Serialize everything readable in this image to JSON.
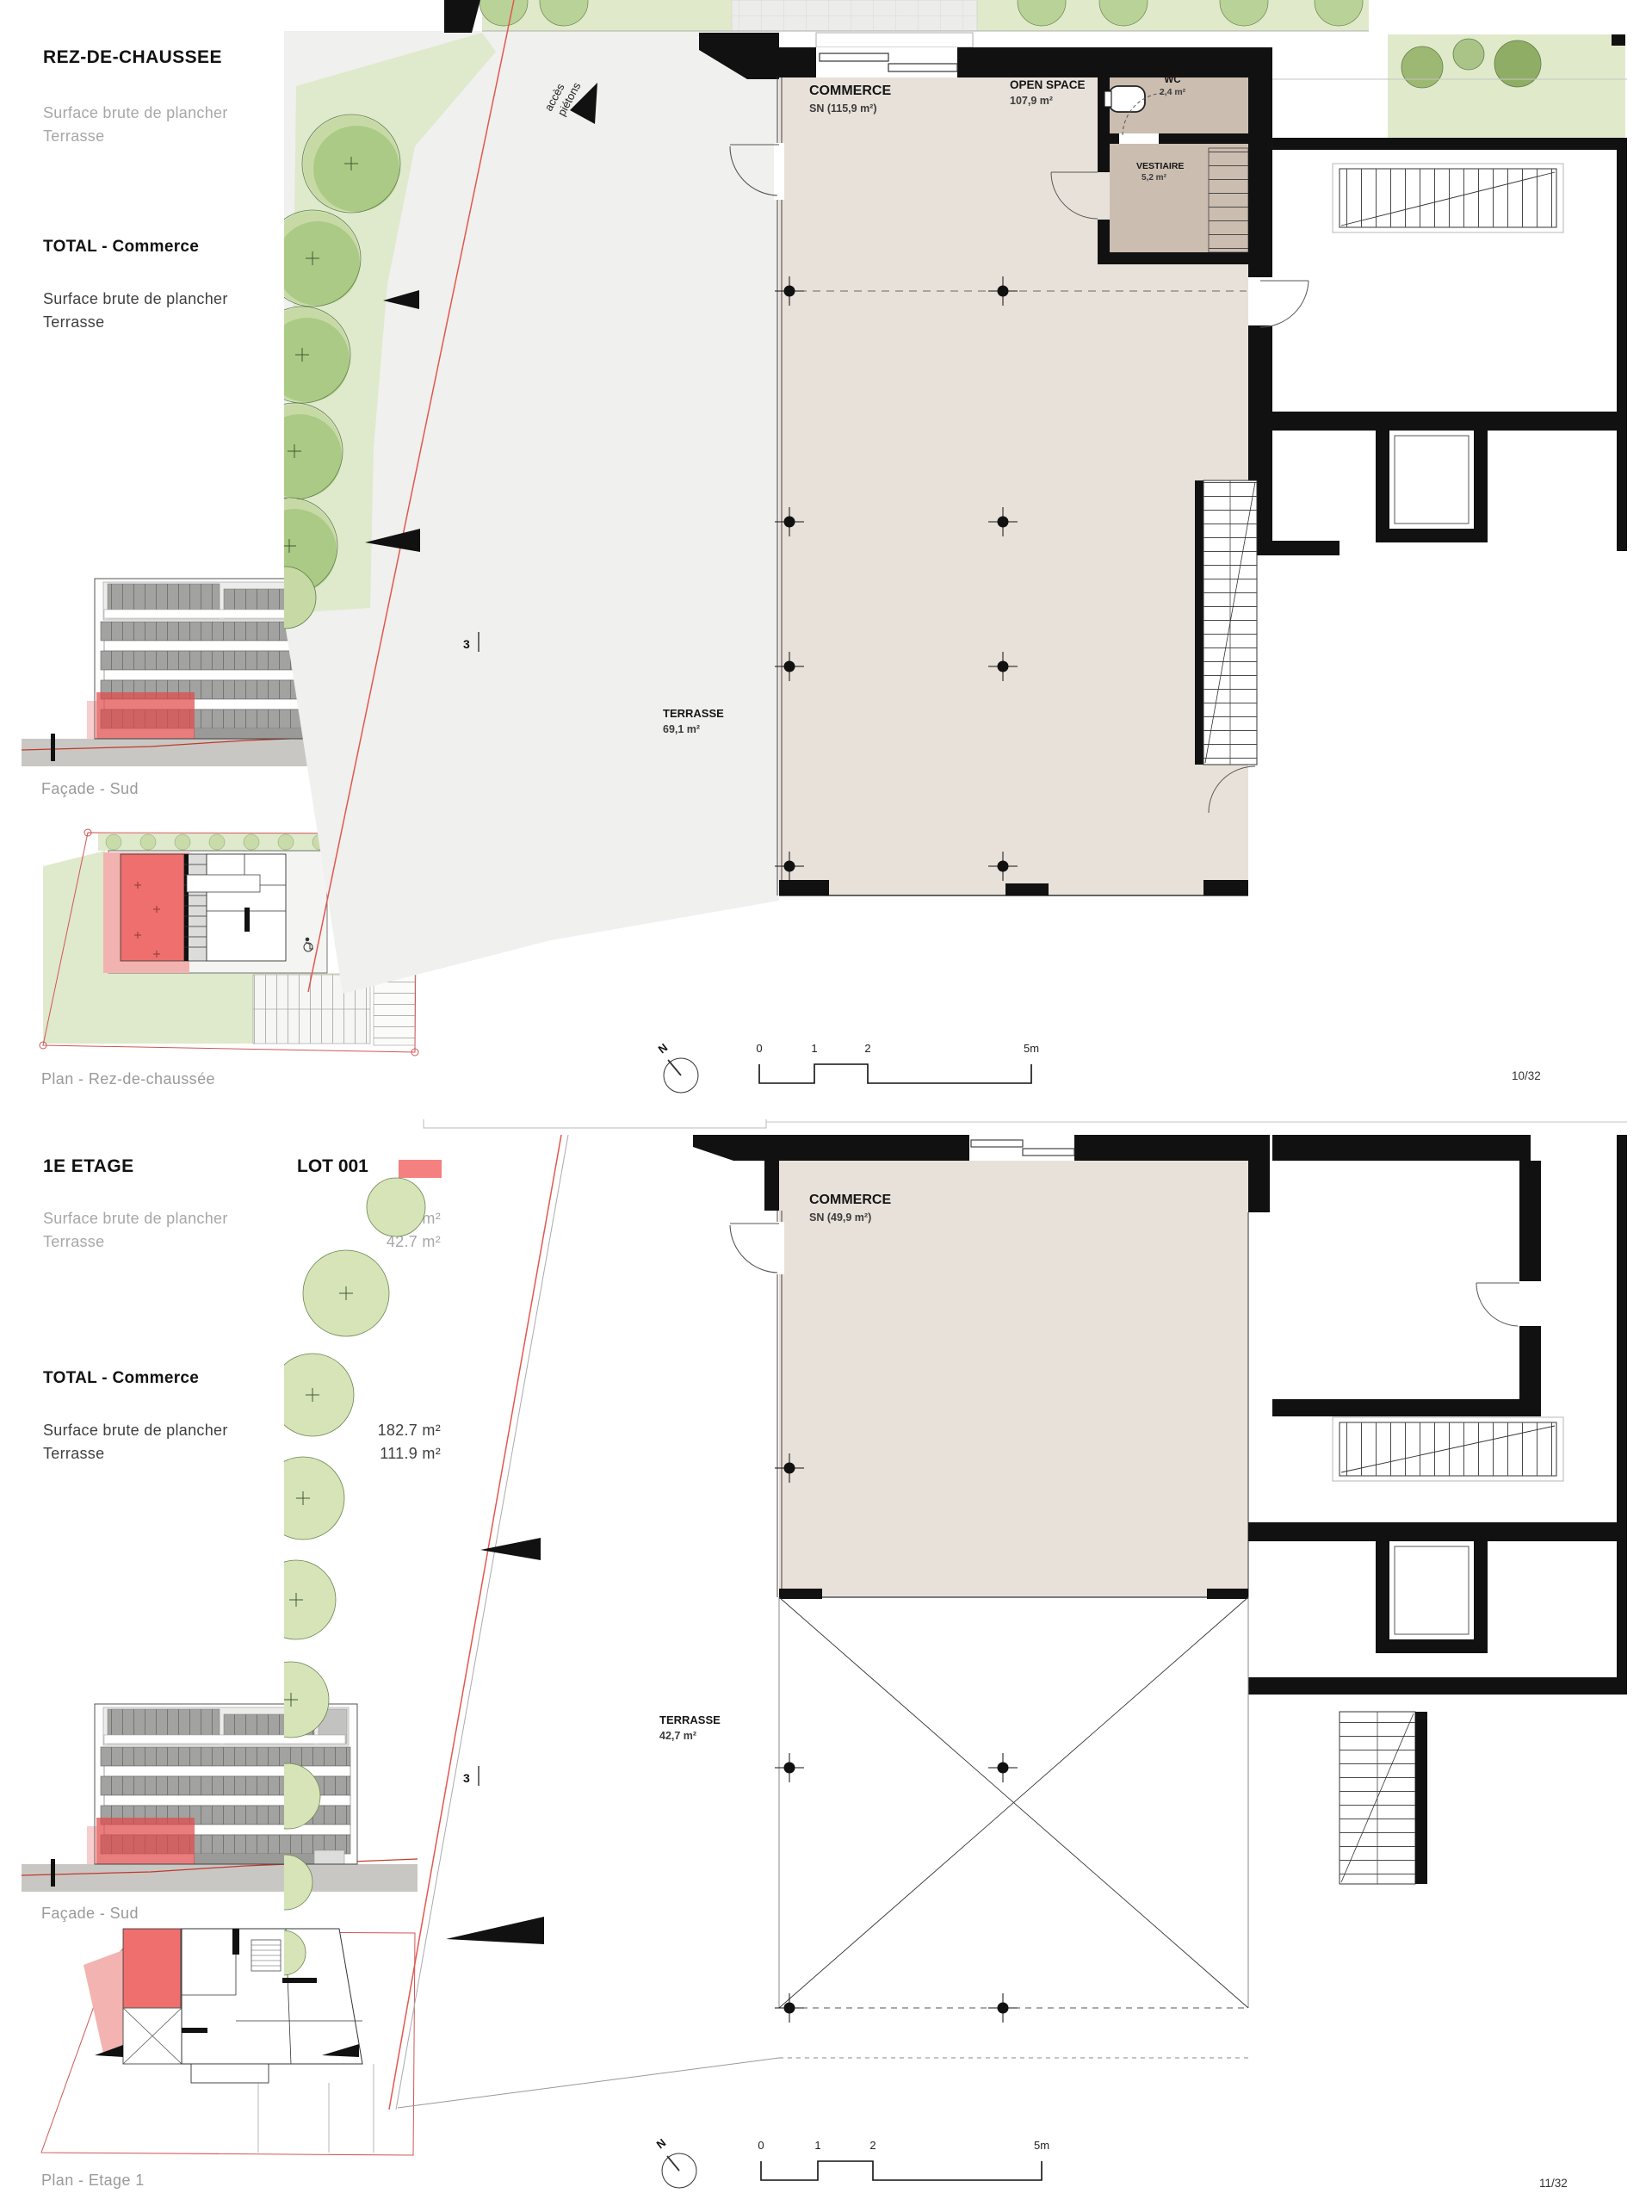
{
  "colors": {
    "accent": "#f4807f",
    "plan_floor": "#e8e1da",
    "wet_room": "#cbbdb0",
    "greenery": "#dfe9cc",
    "tree": "#aac983",
    "boundary_red": "#e2574d"
  },
  "sections": [
    {
      "title": "REZ-DE-CHAUSSEE",
      "lot": "LOT 001",
      "metrics": [
        {
          "label": "Surface brute de plancher",
          "value": "127.2 m²"
        },
        {
          "label": "Terrasse",
          "value": "69.2 m²"
        }
      ],
      "total_title": "TOTAL - Commerce",
      "total_metrics": [
        {
          "label": "Surface brute de plancher",
          "value": "182.7 m²"
        },
        {
          "label": "Terrasse",
          "value": "111.9 m²"
        }
      ],
      "facade_caption": "Façade - Sud",
      "plan_caption": "Plan - Rez-de-chaussée",
      "page_number": "10/32",
      "plan": {
        "commerce": "COMMERCE",
        "commerce_sn": "SN (115,9 m²)",
        "open_space": "OPEN SPACE",
        "open_space_area": "107,9 m²",
        "wc": "WC",
        "wc_area": "2,4 m²",
        "vestiaire": "VESTIAIRE",
        "vestiaire_area": "5,2 m²",
        "terrasse": "TERRASSE",
        "terrasse_area": "69,1 m²",
        "acces_1": "accès",
        "acces_2": "piétons",
        "section_mark": "3",
        "north": "N",
        "scale_ticks": [
          "0",
          "1",
          "2",
          "5m"
        ]
      }
    },
    {
      "title": "1E ETAGE",
      "lot": "LOT 001",
      "metrics": [
        {
          "label": "Surface brute de plancher",
          "value": "55.5 m²"
        },
        {
          "label": "Terrasse",
          "value": "42.7 m²"
        }
      ],
      "total_title": "TOTAL - Commerce",
      "total_metrics": [
        {
          "label": "Surface brute de plancher",
          "value": "182.7 m²"
        },
        {
          "label": "Terrasse",
          "value": "111.9 m²"
        }
      ],
      "facade_caption": "Façade - Sud",
      "plan_caption": "Plan - Etage 1",
      "page_number": "11/32",
      "plan": {
        "commerce": "COMMERCE",
        "commerce_sn": "SN (49,9 m²)",
        "terrasse": "TERRASSE",
        "terrasse_area": "42,7 m²",
        "section_mark": "3",
        "north": "N",
        "scale_ticks": [
          "0",
          "1",
          "2",
          "5m"
        ]
      }
    }
  ]
}
